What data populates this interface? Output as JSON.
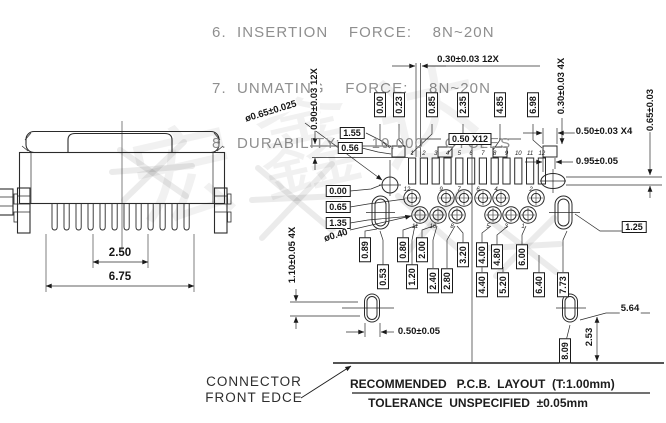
{
  "colors": {
    "line": "#2b2b2b",
    "note_text": "#8f8f8f",
    "label_text": "#161616",
    "background": "#ffffff"
  },
  "notes": {
    "clipped_line": "6. INSERTION  FORCE:  8N~20N",
    "line_7": "7. UNMATING  FORCE:  8N~20N",
    "line_8": "8. DURABILITY:   10,000  CYCLES"
  },
  "front_view": {
    "dim_pitch": "2.50",
    "dim_width": "6.75"
  },
  "pcb": {
    "pad_numbers": [
      "1",
      "2",
      "3",
      "4",
      "5",
      "6",
      "7",
      "8",
      "9",
      "10",
      "11",
      "12"
    ],
    "upper_hole_numbers": [
      "12",
      "9",
      "7",
      "6",
      "4",
      "2"
    ],
    "lower_hole_numbers": [
      "11",
      "10",
      "8",
      "5",
      "3",
      "1"
    ],
    "dim_labels": [
      {
        "id": "top_gap",
        "text": "0.30±0.03  12X"
      },
      {
        "id": "pad_h",
        "text": "0.90±0.03  12X"
      },
      {
        "id": "gap4x",
        "text": "0.30±0.03  4X"
      },
      {
        "id": "right_065",
        "text": "0.65±0.03"
      },
      {
        "id": "x4_050",
        "text": "0.50±0.03  X4"
      },
      {
        "id": "right_095",
        "text": "0.95±0.05"
      },
      {
        "id": "b155",
        "text": "1.55"
      },
      {
        "id": "b056",
        "text": "0.56"
      },
      {
        "id": "b50x12",
        "text": "0.50  X12"
      },
      {
        "id": "dia065",
        "text": "ø0.65±0.025"
      },
      {
        "id": "t000",
        "text": "0.00"
      },
      {
        "id": "t023",
        "text": "0.23"
      },
      {
        "id": "t085",
        "text": "0.85"
      },
      {
        "id": "t235",
        "text": "2.35"
      },
      {
        "id": "t485",
        "text": "4.85"
      },
      {
        "id": "t698",
        "text": "6.98"
      },
      {
        "id": "l000",
        "text": "0.00"
      },
      {
        "id": "l065",
        "text": "0.65"
      },
      {
        "id": "l135",
        "text": "1.35"
      },
      {
        "id": "dia040",
        "text": "ø0.40"
      },
      {
        "id": "v110",
        "text": "1.10±0.05  4X"
      },
      {
        "id": "a089",
        "text": "0.89"
      },
      {
        "id": "a080",
        "text": "0.80"
      },
      {
        "id": "a200",
        "text": "2.00"
      },
      {
        "id": "a320",
        "text": "3.20"
      },
      {
        "id": "a400",
        "text": "4.00"
      },
      {
        "id": "a480",
        "text": "4.80"
      },
      {
        "id": "a600",
        "text": "6.00"
      },
      {
        "id": "c053",
        "text": "0.53"
      },
      {
        "id": "c120",
        "text": "1.20"
      },
      {
        "id": "c240",
        "text": "2.40"
      },
      {
        "id": "c280",
        "text": "2.80"
      },
      {
        "id": "c440",
        "text": "4.40"
      },
      {
        "id": "c520",
        "text": "5.20"
      },
      {
        "id": "c640",
        "text": "6.40"
      },
      {
        "id": "c773",
        "text": "7.73"
      },
      {
        "id": "b125",
        "text": "1.25"
      },
      {
        "id": "d5050",
        "text": "0.50±0.05"
      },
      {
        "id": "d564",
        "text": "5.64"
      },
      {
        "id": "v253",
        "text": "2.53"
      },
      {
        "id": "b809",
        "text": "8.09"
      }
    ]
  },
  "footer": {
    "callout": "CONNECTOR\nFRONT EDCE",
    "title": "RECOMMENDED   P.C.B.  LAYOUT  (T:1.00mm)",
    "tolerance": "TOLERANCE  UNSPECIFIED  ±0.05mm"
  },
  "watermark_text": "宏鑫达"
}
